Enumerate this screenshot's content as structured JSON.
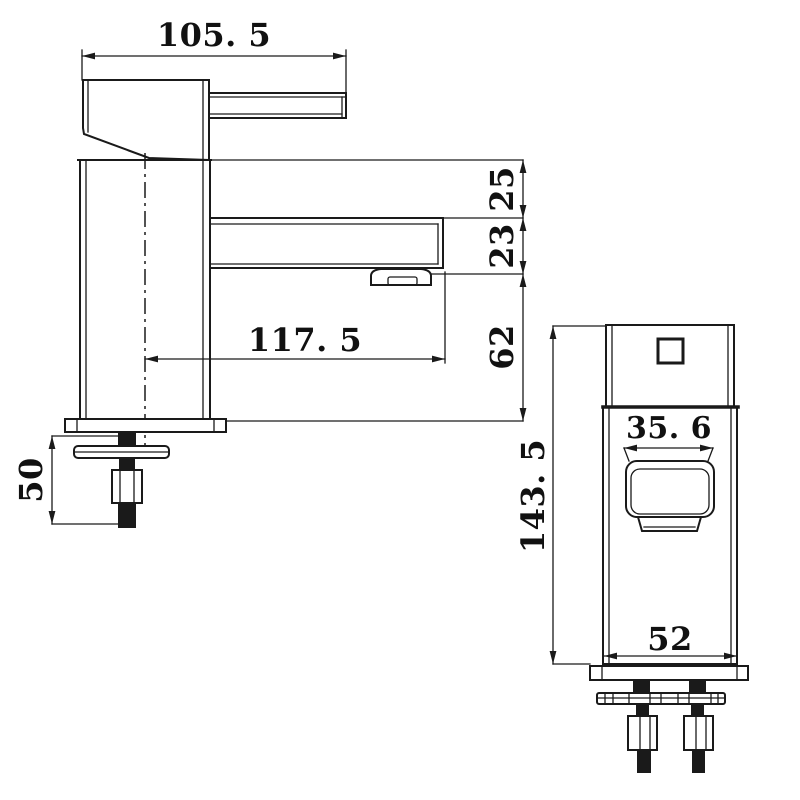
{
  "side_view": {
    "dim_handle_length": "105. 5",
    "dim_body_top_to_spout_top": "25",
    "dim_spout_height": "23",
    "dim_spout_bottom_to_deck": "62",
    "dim_spout_reach": "117. 5",
    "dim_under_deck": "50"
  },
  "front_view": {
    "dim_overall_height": "143. 5",
    "dim_spout_width": "35. 6",
    "dim_body_width": "52"
  },
  "colors": {
    "line": "#1a1a1a",
    "background": "#ffffff"
  }
}
